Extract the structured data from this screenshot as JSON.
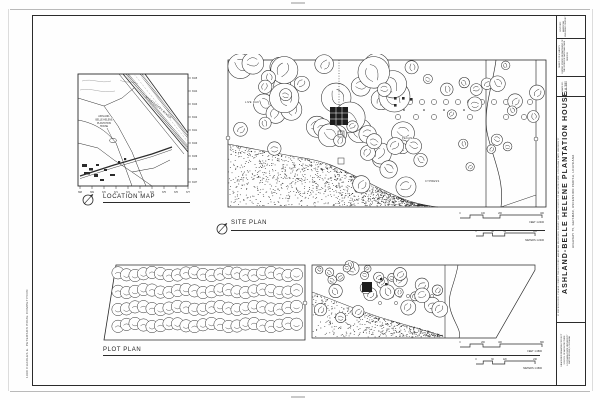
{
  "colors": {
    "ink": "#2b2b2b",
    "paper": "#fefefe",
    "faint": "#b9b9b9"
  },
  "sheet": {
    "competition_note": "1990 CHARLES E. PETERSON PRIZE COMPETITION"
  },
  "location_map": {
    "title": "LOCATION MAP",
    "river_label": "MISSISSIPPI RIVER",
    "site_label_lines": [
      "ASHLAND-",
      "BELLE HELENE",
      "PLANTATION",
      "HOUSE"
    ],
    "right_ticks": [
      "3345",
      "3344",
      "3343",
      "3342",
      "3341",
      "3340",
      "3339",
      "3338",
      "3337"
    ],
    "bottom_ticks": [
      "668",
      "669",
      "670",
      "671",
      "672",
      "673",
      "674",
      "675",
      "676",
      "677"
    ]
  },
  "site_plan": {
    "title": "SITE PLAN",
    "labels": {
      "live_oak": "LIVE OAK",
      "pecan": "PECAN",
      "cypress": "CYPRESS"
    },
    "scales": {
      "feet_ticks": [
        "0",
        "100",
        "200",
        "400"
      ],
      "feet_label": "FEET  1:2400",
      "meter_ticks": [
        "0",
        "30",
        "60",
        "120"
      ],
      "meter_label": "METERS  1:2400"
    }
  },
  "plot_plan": {
    "title": "PLOT PLAN",
    "scales": {
      "feet_ticks": [
        "0",
        "200",
        "400",
        "800"
      ],
      "feet_label": "FEET  1:4800",
      "meter_ticks": [
        "0",
        "60",
        "120",
        "240"
      ],
      "meter_label": "METERS  1:4800"
    }
  },
  "title_block": {
    "survey_title": "HISTORIC AMERICAN BUILDINGS SURVEY",
    "sheet_info": "SHEET 2 OF 8 SHEETS",
    "dept_note": "UNITED STATES DEPARTMENT OF THE INTERIOR NATIONAL PARK SERVICE",
    "survey_no_label": "HABS NO.",
    "survey_no": "LA-380",
    "main_title": "ASHLAND-BELLE HELENE PLANTATION HOUSE",
    "subtitle": "HIGHWAY 75, GEISMAR, ASCENSION PARISH, LOUISIANA",
    "fine_print": "IF REPRODUCED, PLEASE CREDIT THE HISTORIC AMERICAN BUILDINGS SURVEY AND THE SCHOOL OF ARCHITECTURE, LOUISIANA STATE UNIVERSITY",
    "credits": [
      "MEASURED DRAWING PROJECT",
      "SCHOOL OF ARCHITECTURE",
      "LOUISIANA STATE UNIVERSITY",
      "BATON ROUGE, LOUISIANA"
    ]
  }
}
